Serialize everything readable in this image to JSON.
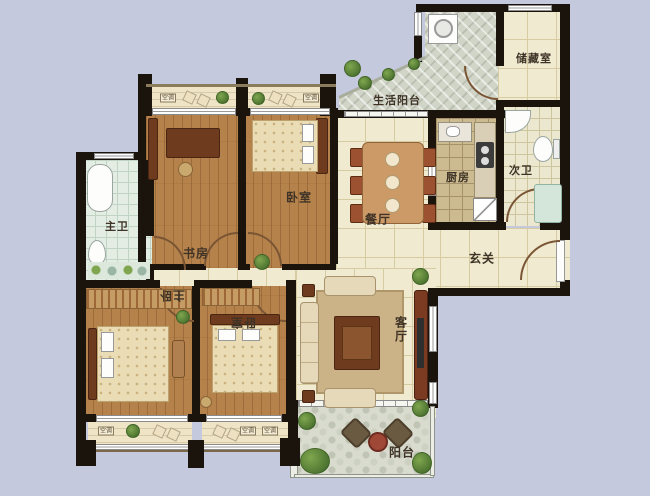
{
  "plan": {
    "type": "apartment-floor-plan",
    "labels": {
      "study": "书房",
      "bedroom_top": "卧室",
      "master_bath": "主卫",
      "utility_balcony": "生活阳台",
      "storage": "储藏室",
      "kitchen": "厨房",
      "second_bath": "次卫",
      "dining": "餐厅",
      "foyer": "玄关",
      "master_bedroom": "主卧",
      "bedroom_bottom": "卧室",
      "living": "客厅",
      "balcony": "阳台",
      "ac": "空调"
    },
    "colors": {
      "background": "#c5c9de",
      "wall": "#1b140d",
      "tile_floor": "#f0ead0",
      "wood_floor": "#b5824b",
      "bath_tile": "#e3ede4",
      "kitchen_tile": "#ccba90",
      "balcony_stone": "#d1d5c7",
      "door_arc": "#7a5534"
    }
  }
}
